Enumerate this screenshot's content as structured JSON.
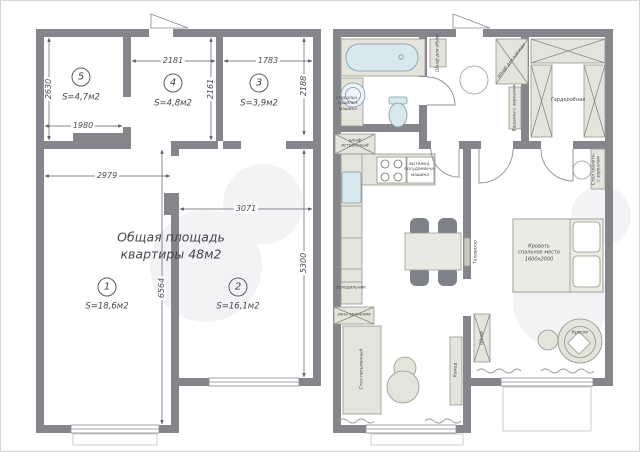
{
  "watermark": {
    "brand": "Avito"
  },
  "colors": {
    "wall": "#84868c",
    "furniture": "#e4e4dc",
    "plumbing": "#d8e8ef",
    "dim_text": "#4a4a52"
  },
  "plan_left": {
    "title": {
      "line1": "Общая площадь",
      "line2": "квартиры 48м2"
    },
    "rooms": {
      "r5": {
        "num": "5",
        "area": "S=4,7м2"
      },
      "r4": {
        "num": "4",
        "area": "S=4,8м2"
      },
      "r3": {
        "num": "3",
        "area": "S=3,9м2"
      },
      "r1": {
        "num": "1",
        "area": "S=18,6м2"
      },
      "r2": {
        "num": "2",
        "area": "S=16,1м2"
      }
    },
    "dims": {
      "d2181": "2181",
      "d1783": "1783",
      "d2630": "2630",
      "d1980": "1980",
      "d2161": "2161",
      "d2188": "2188",
      "d2979": "2979",
      "d3071": "3071",
      "d6564": "6564",
      "d5300": "5300"
    }
  },
  "plan_right": {
    "labels": {
      "washer": "стиральн.-\nсушильн.\nмашина",
      "builtin_wardrobe": "шкаф\nвстроенный",
      "shoe_cabinet": "Шкаф для обуви",
      "hall_wardrobe": "Шкаф для одежды",
      "mirror_hanger": "Вешалка с зеркалом",
      "walkin_closet": "Гардеробная",
      "appliance_note": "вытяжка,\nпосудомоечн.\nмашина",
      "fridge": "холодильник",
      "storage": "зона хранения",
      "desk": "Стол письменный",
      "dresser": "Комод",
      "tv": "Телевизор",
      "bed": "Кровать\nспальное место\n1600х2000",
      "vanity": "Стол туалетн.\nс зеркалом",
      "linen_wardrobe": "Шкаф",
      "armchair": "Кресло"
    }
  }
}
